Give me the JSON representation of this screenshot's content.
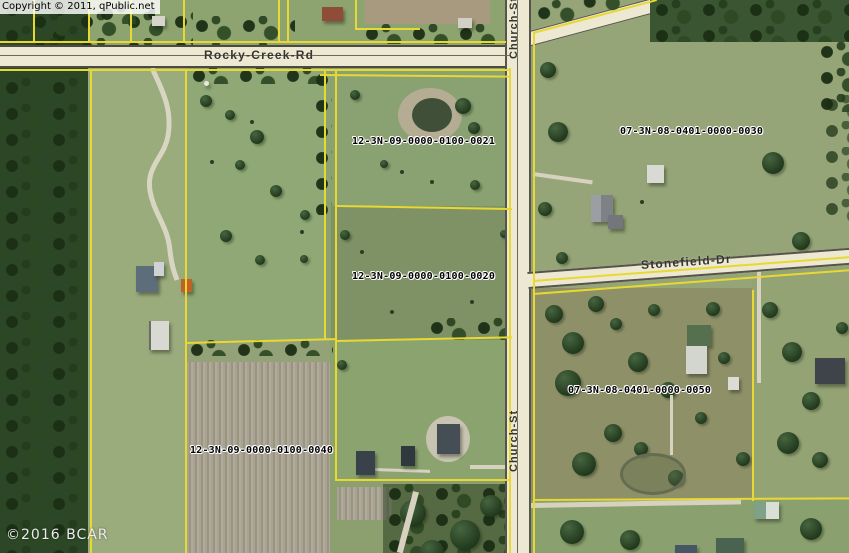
{
  "attribution": {
    "top": "Copyright © 2011, qPublic.net",
    "bottom": "©2016 BCAR"
  },
  "roads": {
    "rocky_creek": {
      "label": "Rocky-Creek-Rd"
    },
    "church_top": {
      "label": "Church-St"
    },
    "church_bottom": {
      "label": "Church-St"
    },
    "stonefield": {
      "label": "Stonefield-Dr"
    }
  },
  "parcels": [
    {
      "id": "12-3N-09-0000-0100-0021"
    },
    {
      "id": "12-3N-09-0000-0100-0020"
    },
    {
      "id": "12-3N-09-0000-0100-0040"
    },
    {
      "id": "07-3N-08-0401-0000-0030"
    },
    {
      "id": "07-3N-08-0401-0000-0050"
    }
  ],
  "colors": {
    "parcel_line": "#e8d833",
    "road_fill": "#ece8d1",
    "road_edge": "#4c4a42",
    "field_green": "#8ca06f",
    "forest_green": "#2c4726"
  }
}
